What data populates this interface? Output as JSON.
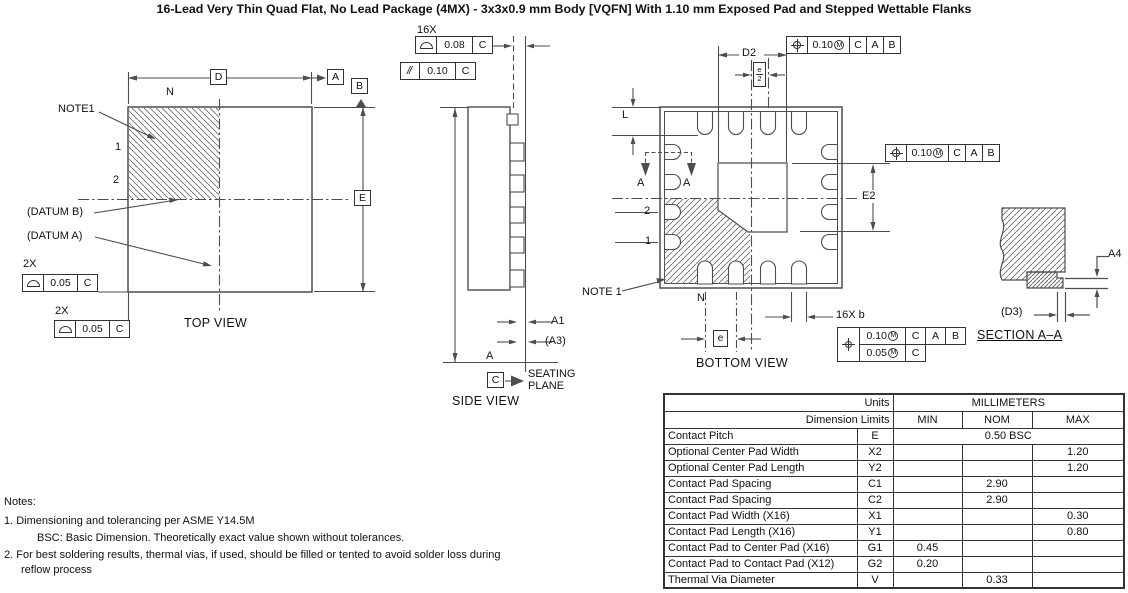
{
  "title": "16-Lead Very Thin Quad Flat, No Lead Package (4MX) - 3x3x0.9 mm Body [VQFN] With 1.10 mm Exposed Pad and Stepped Wettable Flanks",
  "colors": {
    "line": "#4d4d4d",
    "text": "#111111",
    "background": "#ffffff"
  },
  "top_view": {
    "view_label": "TOP VIEW",
    "note_label": "NOTE1",
    "n_label": "N",
    "pin1": "1",
    "pin2": "2",
    "datum_b_label": "(DATUM B)",
    "datum_a_label": "(DATUM A)",
    "dim_d_box": "D",
    "datum_box_a": "A",
    "datum_box_b": "B",
    "dim_e_box": "E",
    "fcf1_qty": "2X",
    "fcf1_tol": "0.05",
    "fcf1_datum": "C",
    "fcf2_qty": "2X",
    "fcf2_tol": "0.05",
    "fcf2_datum": "C"
  },
  "side_view": {
    "view_label": "SIDE VIEW",
    "fcf1_qty": "16X",
    "fcf1_tol": "0.08",
    "fcf1_datum": "C",
    "fcf2_sym": "//",
    "fcf2_tol": "0.10",
    "fcf2_datum": "C",
    "dim_a1": "A1",
    "dim_a3": "(A3)",
    "dim_a": "A",
    "datum_c_box": "C",
    "seating1": "SEATING",
    "seating2": "PLANE"
  },
  "bottom_view": {
    "view_label": "BOTTOM VIEW",
    "dim_d2": "D2",
    "dim_l": "L",
    "dim_e2": "E2",
    "sec_arrow_a1": "A",
    "sec_arrow_a2": "A",
    "pin1": "1",
    "pin2": "2",
    "note_label": "NOTE 1",
    "n_label": "N",
    "e_frac_num": "e",
    "e_frac_den": "2",
    "dim_e_box": "e",
    "dim_b_label": "16X b",
    "fcf_top": {
      "tol": "0.10",
      "mod": "M",
      "d1": "C",
      "d2": "A",
      "d3": "B"
    },
    "fcf_right": {
      "tol": "0.10",
      "mod": "M",
      "d1": "C",
      "d2": "A",
      "d3": "B"
    },
    "fcf_comp": {
      "row1_tol": "0.10",
      "row1_mod": "M",
      "row1_d1": "C",
      "row1_d2": "A",
      "row1_d3": "B",
      "row2_tol": "0.05",
      "row2_mod": "M",
      "row2_d1": "C"
    }
  },
  "section_view": {
    "view_label": "SECTION A–A",
    "dim_a4": "A4",
    "dim_d3": "(D3)"
  },
  "notes": {
    "heading": "Notes:",
    "line1": "1.  Dimensioning and tolerancing per ASME Y14.5M",
    "line2": "BSC: Basic Dimension. Theoretically exact value shown without tolerances.",
    "line3": "2.  For best soldering results, thermal vias, if used, should be filled or tented to avoid solder loss during",
    "line4": "reflow process"
  },
  "table": {
    "units_label": "Units",
    "units_value": "MILLIMETERS",
    "limits_label": "Dimension Limits",
    "col_min": "MIN",
    "col_nom": "NOM",
    "col_max": "MAX",
    "rows": [
      {
        "name": "Contact Pitch",
        "sym": "E",
        "span": "0.50 BSC"
      },
      {
        "name": "Optional Center Pad Width",
        "sym": "X2",
        "min": "",
        "nom": "",
        "max": "1.20"
      },
      {
        "name": "Optional Center Pad Length",
        "sym": "Y2",
        "min": "",
        "nom": "",
        "max": "1.20"
      },
      {
        "name": "Contact Pad Spacing",
        "sym": "C1",
        "min": "",
        "nom": "2.90",
        "max": ""
      },
      {
        "name": "Contact Pad Spacing",
        "sym": "C2",
        "min": "",
        "nom": "2.90",
        "max": ""
      },
      {
        "name": "Contact Pad Width (X16)",
        "sym": "X1",
        "min": "",
        "nom": "",
        "max": "0.30"
      },
      {
        "name": "Contact Pad Length (X16)",
        "sym": "Y1",
        "min": "",
        "nom": "",
        "max": "0.80"
      },
      {
        "name": "Contact Pad to Center Pad (X16)",
        "sym": "G1",
        "min": "0.45",
        "nom": "",
        "max": ""
      },
      {
        "name": "Contact Pad to Contact Pad (X12)",
        "sym": "G2",
        "min": "0.20",
        "nom": "",
        "max": ""
      },
      {
        "name": "Thermal Via Diameter",
        "sym": "V",
        "min": "",
        "nom": "0.33",
        "max": ""
      }
    ]
  }
}
